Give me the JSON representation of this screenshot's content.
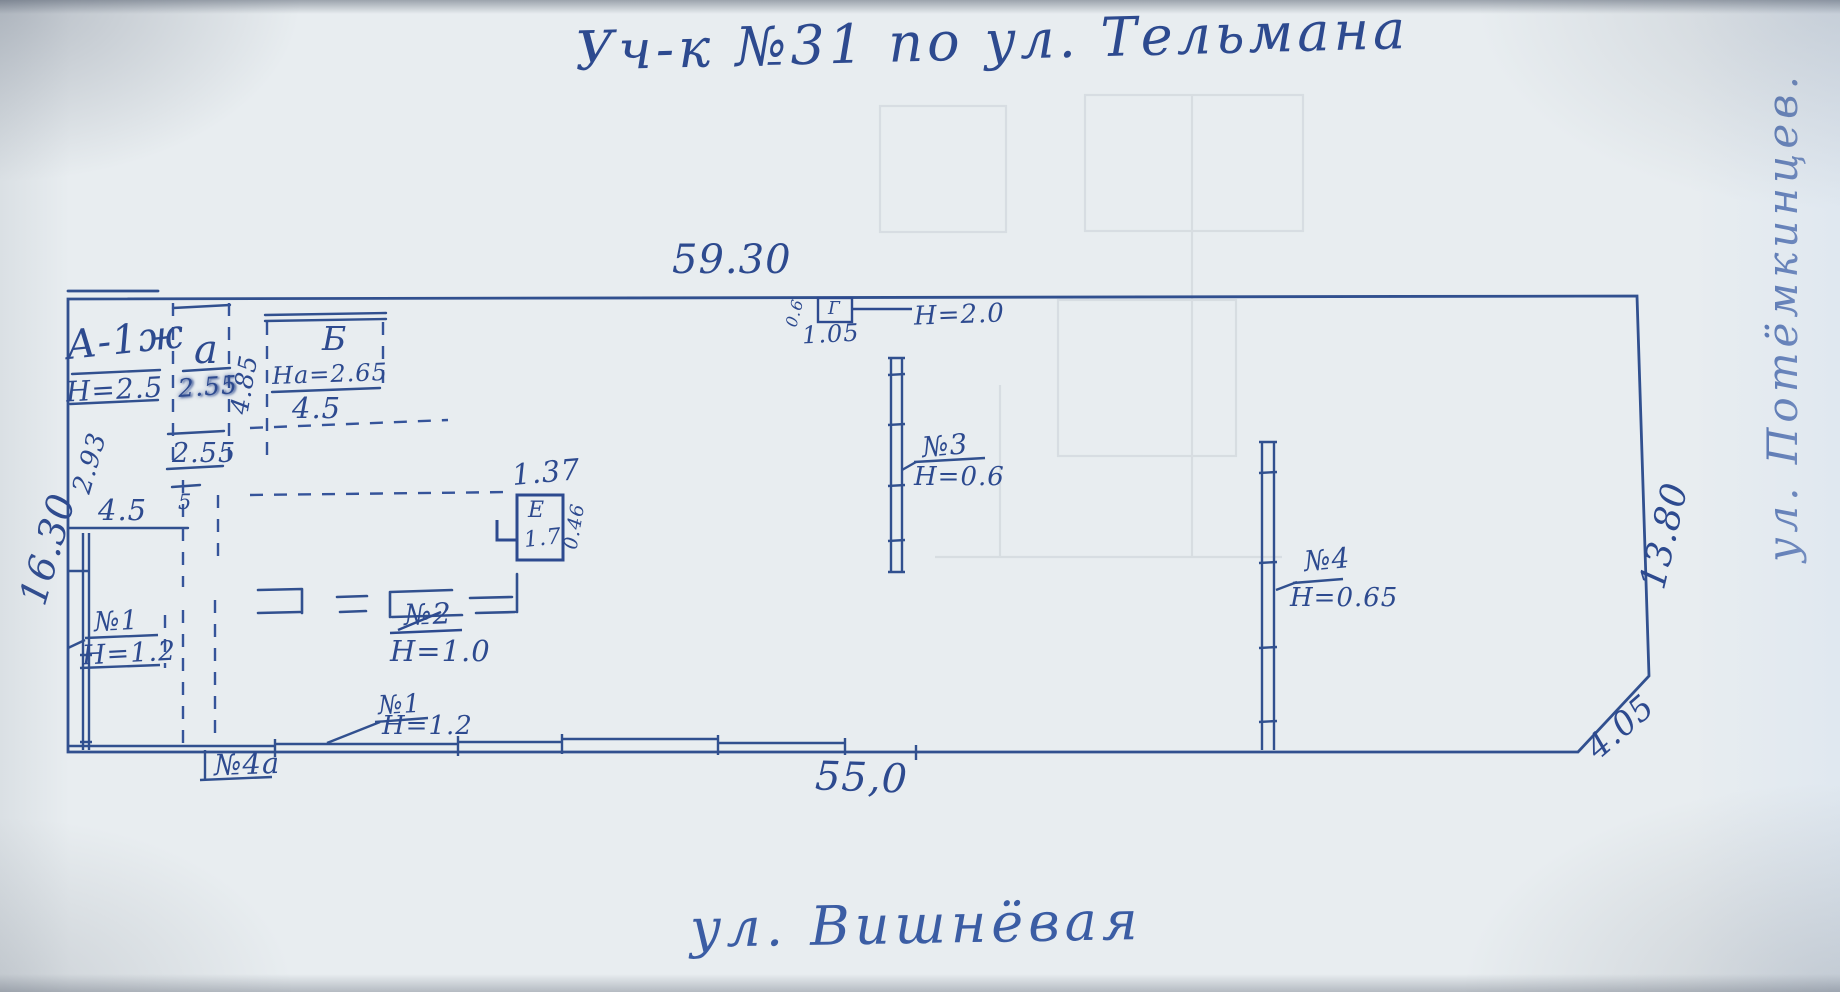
{
  "title": "Уч-к №31 по ул. Тельмана",
  "streets": {
    "bottom": "ул. Вишнёвая",
    "right": "ул. Потёмкинцев."
  },
  "plot": {
    "top_length": "59.30",
    "left_length": "16.30",
    "right_length": "13.80",
    "bottom_length": "55,0",
    "corner_cut": "4.05"
  },
  "inner_dimensions": {
    "left_upper": "2.93",
    "left_partition": "4.5",
    "small_mark": "5",
    "annex_column_side": "4.85",
    "annex_width_upper": "2.55",
    "annex_width_lower": "2.55"
  },
  "buildings": {
    "main_house": {
      "label": "А-1ж",
      "height": "Н=2.5"
    },
    "annex_a": {
      "label": "а"
    },
    "block_b": {
      "label": "Б",
      "inner_height": "На=2.65",
      "width": "4.5"
    },
    "shed_e": {
      "label": "Е",
      "area": "1.7",
      "width": "1.37",
      "depth": "0.46"
    },
    "gate_g": {
      "label": "Г",
      "width": "1.05",
      "depth": "0.6",
      "height": "Н=2.0"
    }
  },
  "fences": {
    "no1_left": {
      "label": "№1",
      "height": "Н=1.2"
    },
    "no1_bottom": {
      "label": "№1",
      "height": "Н=1.2"
    },
    "no2": {
      "label": "№2",
      "height": "Н=1.0"
    },
    "no3": {
      "label": "№3",
      "height": "Н=0.6"
    },
    "no4": {
      "label": "№4",
      "height": "Н=0.65"
    },
    "no4a": {
      "label": "№4а"
    }
  },
  "colors": {
    "ink": "#2d4a8f",
    "paper": "#e8edf0"
  }
}
